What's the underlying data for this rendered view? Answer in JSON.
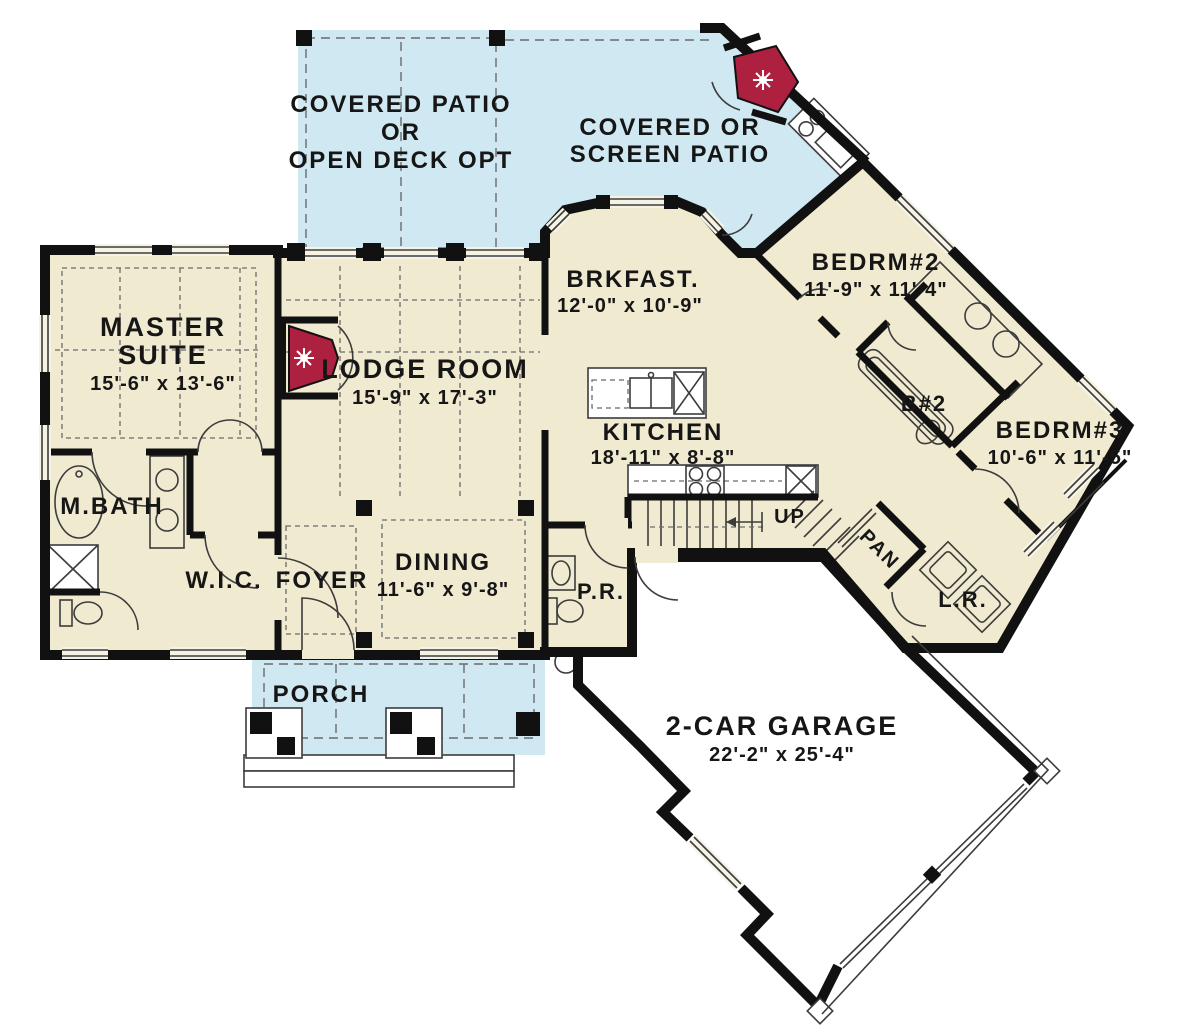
{
  "drawing": {
    "type": "first-floor-plan",
    "colors": {
      "floor": "#f0ead0",
      "patio": "#cfe8f1",
      "garage_floor": "#ffffff",
      "walls": "#111111",
      "fireplace_red": "#ad2040"
    }
  },
  "rooms": {
    "patio1": {
      "line1": "COVERED PATIO",
      "line2": "OR",
      "line3": "OPEN DECK OPT"
    },
    "patio2": {
      "line1": "COVERED OR",
      "line2": "SCREEN PATIO"
    },
    "master": {
      "line1": "MASTER",
      "line2": "SUITE",
      "dims": "15'-6\" x 13'-6\""
    },
    "lodge": {
      "name": "LODGE ROOM",
      "dims": "15'-9\" x 17'-3\""
    },
    "brkfast": {
      "name": "BRKFAST.",
      "dims": "12'-0\" x 10'-9\""
    },
    "kitchen": {
      "name": "KITCHEN",
      "dims": "18'-11\" x 8'-8\""
    },
    "bedrm2": {
      "name": "BEDRM#2",
      "dims": "11'-9\" x 11'-4\""
    },
    "bath2": {
      "name": "B#2"
    },
    "bedrm3": {
      "name": "BEDRM#3",
      "dims": "10'-6\" x 11'-5\""
    },
    "mbath": {
      "name": "M.BATH"
    },
    "wic": {
      "name": "W.I.C."
    },
    "foyer": {
      "name": "FOYER"
    },
    "dining": {
      "name": "DINING",
      "dims": "11'-6\" x 9'-8\""
    },
    "powder": {
      "name": "P.R."
    },
    "stairs": {
      "name": "UP"
    },
    "pantry": {
      "name": "PAN"
    },
    "laundry": {
      "name": "L.R."
    },
    "porch": {
      "name": "PORCH"
    },
    "garage": {
      "name": "2-CAR GARAGE",
      "dims": "22'-2\" x 25'-4\""
    }
  }
}
